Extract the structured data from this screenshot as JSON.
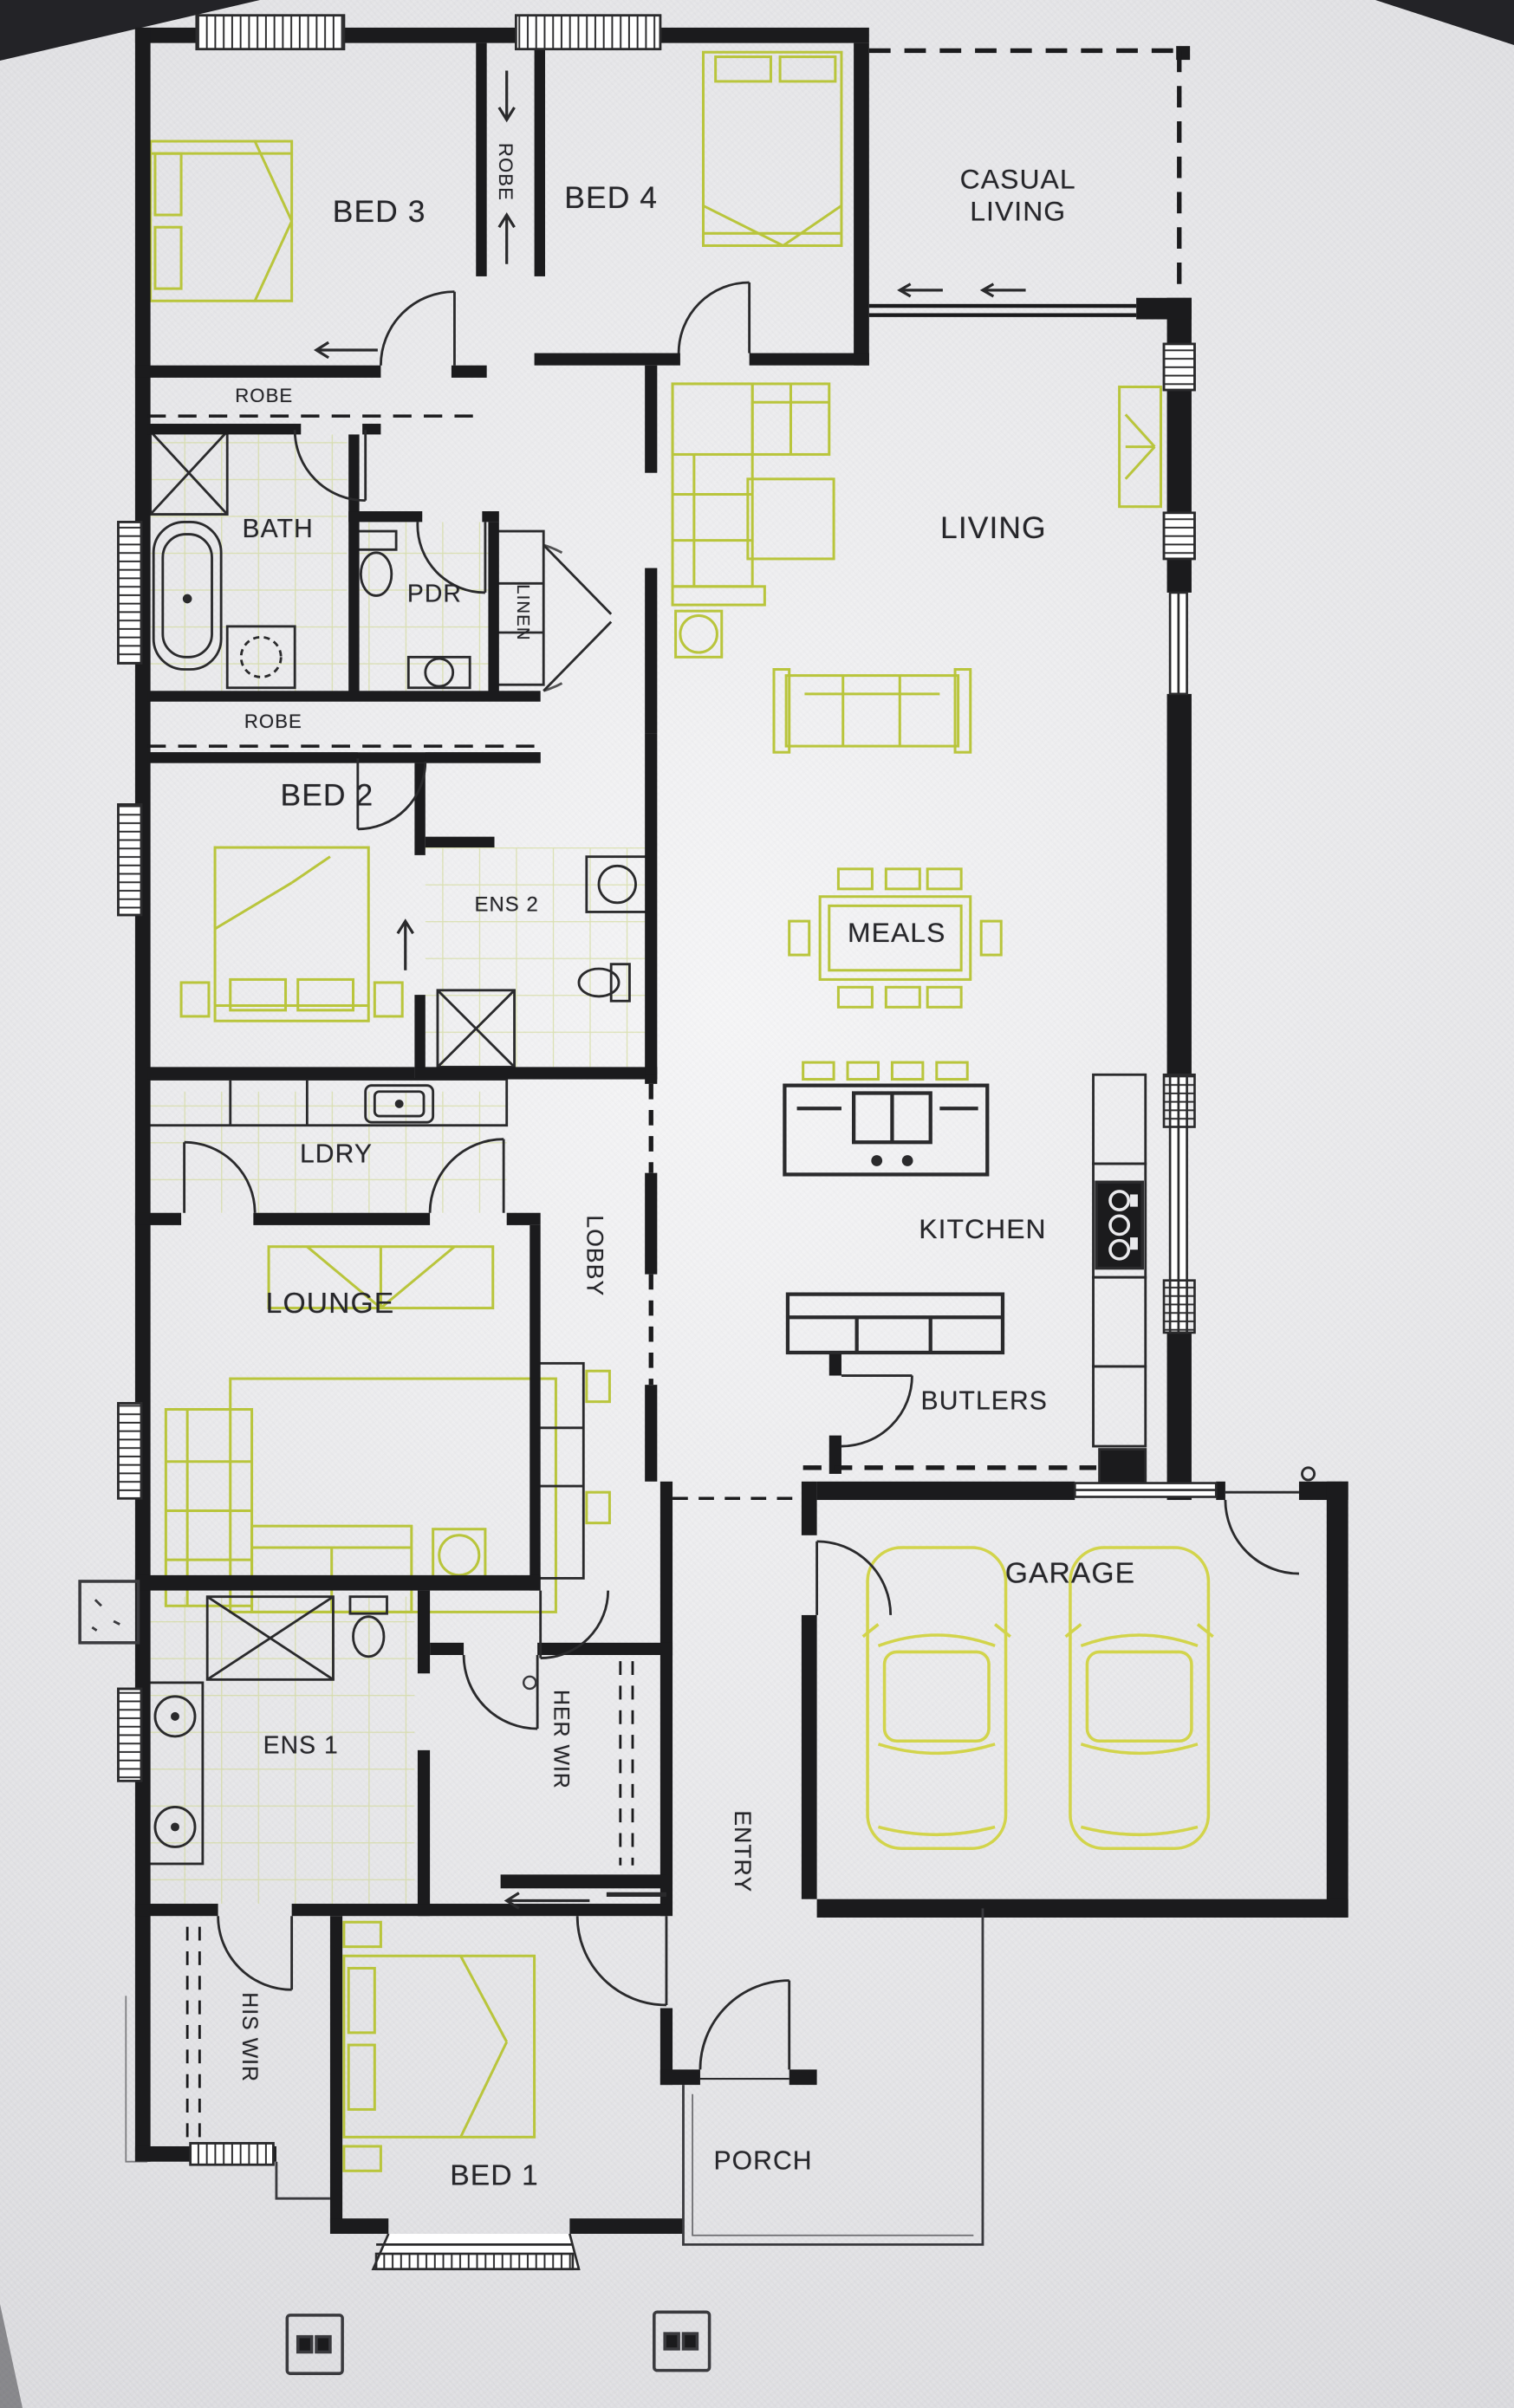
{
  "document": {
    "type": "scanned architectural floor plan",
    "style": "black ink walls on textured white paper, furniture highlighted in yellow-green pencil"
  },
  "colors": {
    "paper": "#e9e9ec",
    "wall": "#1b1b1d",
    "fixture_line": "#2a2a2c",
    "furniture_highlight": "#b9c53c",
    "car_highlight": "#d2d44b",
    "tile_highlight": "#ccd687",
    "label_text": "#26262a"
  },
  "rooms": [
    {
      "id": "bed3",
      "label": "BED 3",
      "orientation": "horizontal"
    },
    {
      "id": "robe-corridor",
      "label": "ROBE",
      "orientation": "vertical"
    },
    {
      "id": "bed4",
      "label": "BED 4",
      "orientation": "horizontal"
    },
    {
      "id": "casual-living",
      "label": "CASUAL LIVING",
      "orientation": "horizontal"
    },
    {
      "id": "robe-bed3",
      "label": "ROBE",
      "orientation": "horizontal"
    },
    {
      "id": "bath",
      "label": "BATH",
      "orientation": "horizontal"
    },
    {
      "id": "pdr",
      "label": "PDR",
      "orientation": "horizontal"
    },
    {
      "id": "linen",
      "label": "LINEN",
      "orientation": "vertical"
    },
    {
      "id": "living",
      "label": "LIVING",
      "orientation": "horizontal"
    },
    {
      "id": "robe-bed2",
      "label": "ROBE",
      "orientation": "horizontal"
    },
    {
      "id": "bed2",
      "label": "BED 2",
      "orientation": "horizontal"
    },
    {
      "id": "ens2",
      "label": "ENS 2",
      "orientation": "horizontal"
    },
    {
      "id": "meals",
      "label": "MEALS",
      "orientation": "horizontal"
    },
    {
      "id": "ldry",
      "label": "LDRY",
      "orientation": "horizontal"
    },
    {
      "id": "lobby",
      "label": "LOBBY",
      "orientation": "vertical"
    },
    {
      "id": "kitchen",
      "label": "KITCHEN",
      "orientation": "horizontal"
    },
    {
      "id": "lounge",
      "label": "LOUNGE",
      "orientation": "horizontal"
    },
    {
      "id": "butlers",
      "label": "BUTLERS",
      "orientation": "horizontal"
    },
    {
      "id": "garage",
      "label": "GARAGE",
      "orientation": "horizontal"
    },
    {
      "id": "ens1",
      "label": "ENS 1",
      "orientation": "horizontal"
    },
    {
      "id": "her-wir",
      "label": "HER WIR",
      "orientation": "vertical"
    },
    {
      "id": "entry",
      "label": "ENTRY",
      "orientation": "vertical"
    },
    {
      "id": "his-wir",
      "label": "HIS WIR",
      "orientation": "vertical"
    },
    {
      "id": "bed1",
      "label": "BED 1",
      "orientation": "horizontal"
    },
    {
      "id": "porch",
      "label": "PORCH",
      "orientation": "horizontal"
    }
  ],
  "fixtures": [
    "bathtub",
    "shower x3",
    "toilet x3",
    "vanity-basins",
    "laundry-sink",
    "kitchen-island-with-sink",
    "cooktop",
    "butlers-bench",
    "study-desk",
    "dining-table-8-chairs",
    "corner-sofa",
    "sofa",
    "ottoman",
    "tv-unit",
    "double-bed x4",
    "car x2",
    "meter-box x2",
    "hatched-windows",
    "door-swing-arcs"
  ]
}
